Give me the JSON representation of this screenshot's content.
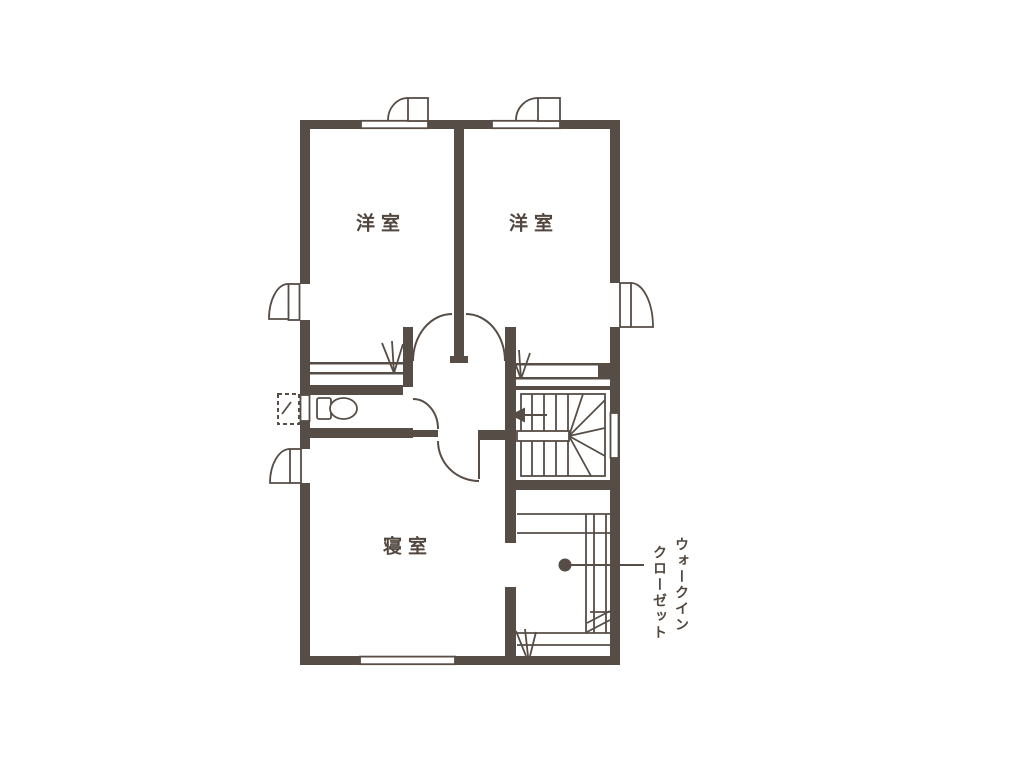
{
  "plan": {
    "labels": {
      "western_room_1": "洋室",
      "western_room_2": "洋室",
      "bedroom": "寝室",
      "walk_in_closet_line1": "ウォークイン",
      "walk_in_closet_line2": "クローゼット"
    },
    "colors": {
      "wall": "#574d47",
      "text": "#51473f",
      "background": "#ffffff"
    }
  }
}
